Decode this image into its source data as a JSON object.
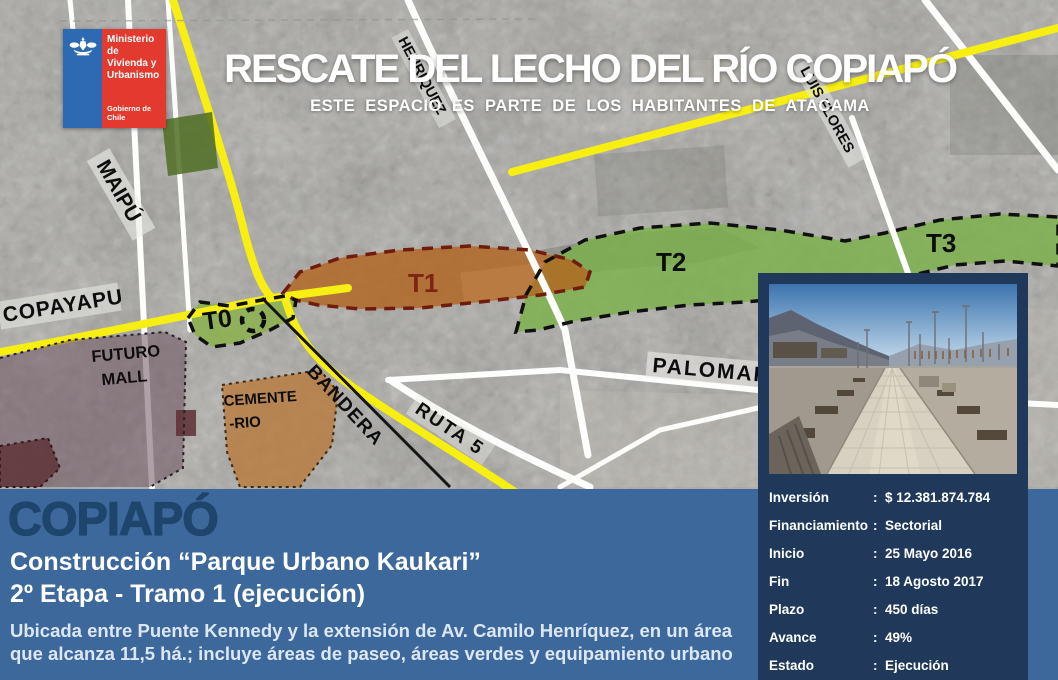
{
  "logo": {
    "ministry_lines": [
      "Ministerio de",
      "Vivienda y",
      "Urbanismo"
    ],
    "government": "Gobierno de Chile"
  },
  "header": {
    "title": "RESCATE DEL LECHO DEL RÍO COPIAPÓ",
    "subtitle": "ESTE ESPACIO ES PARTE DE LOS HABITANTES DE ATACAMA"
  },
  "map": {
    "zones": {
      "t0": "T0",
      "t1": "T1",
      "t2": "T2",
      "t3": "T3"
    },
    "labels": {
      "maipu": "MAIPÚ",
      "copayapu": "COPAYAPU",
      "henriquez": "HENRIQUEZ",
      "luis_flores": "LUIS FLORES",
      "bandera": "BANDERA",
      "ruta5": "RUTA 5",
      "palomar": "PALOMAR",
      "futuro_mall_1": "FUTURO",
      "futuro_mall_2": "MALL",
      "cementerio_1": "CEMENTE",
      "cementerio_2": "-RIO"
    }
  },
  "project": {
    "city": "COPIAPÓ",
    "name": "Construcción “Parque Urbano Kaukari”",
    "stage": "2º Etapa - Tramo 1 (ejecución)",
    "description_line1": "Ubicada entre Puente Kennedy y la extensión de Av. Camilo Henríquez, en un área",
    "description_line2": "que alcanza 11,5 há.; incluye áreas de paseo, áreas verdes y equipamiento urbano"
  },
  "details": {
    "rows": [
      {
        "label": "Inversión",
        "value": "$ 12.381.874.784"
      },
      {
        "label": "Financiamiento",
        "value": "Sectorial"
      },
      {
        "label": "Inicio",
        "value": "25 Mayo 2016"
      },
      {
        "label": "Fin",
        "value": "18 Agosto 2017"
      },
      {
        "label": "Plazo",
        "value": "450 días"
      },
      {
        "label": "Avance",
        "value": "49%"
      },
      {
        "label": "Estado",
        "value": "Ejecución"
      }
    ]
  },
  "colors": {
    "strip_blue": "#3d689b",
    "panel_navy": "#20395b",
    "city_text": "#1e456b",
    "road_yellow": "#f7ee12",
    "zone_green": "#7cb14a",
    "zone_orange": "#b2641e",
    "logo_red": "#e23a2e",
    "logo_blue": "#2e6ab3"
  }
}
